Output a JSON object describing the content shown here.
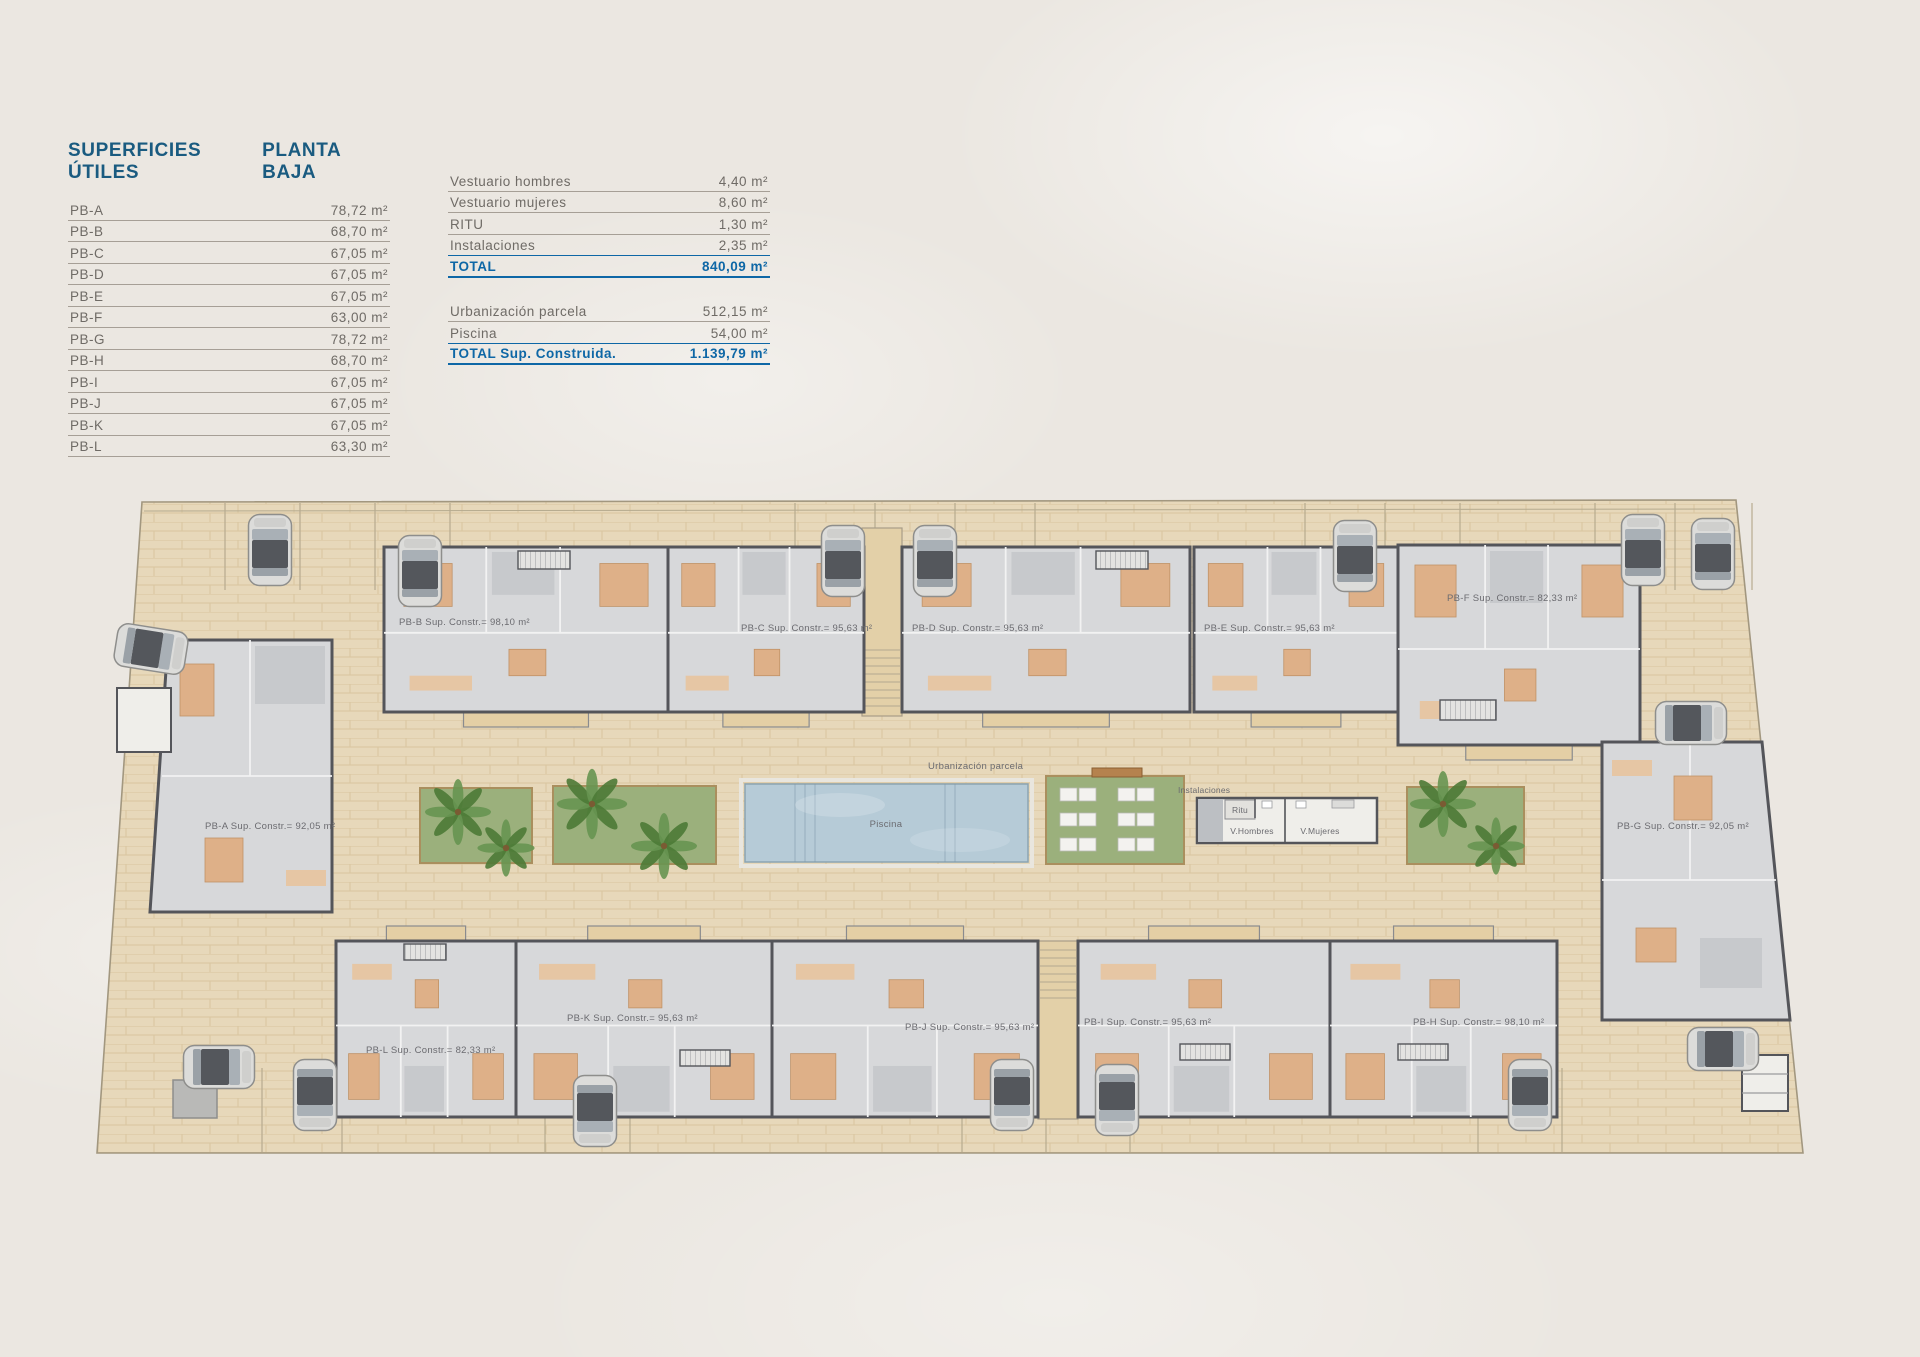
{
  "page": {
    "caption": "PLANTA BAJA"
  },
  "colors": {
    "title_blue": "#1a5b80",
    "total_blue": "#0e67a6",
    "row_text": "#6f6b66",
    "paving_tan": "#e7d8ba",
    "wall_gray": "#54555a",
    "floor_gray": "#d7d8da",
    "pool_blue": "#b6cbd7",
    "grass_green": "#9bb07c",
    "furniture_orange": "#deb088"
  },
  "tables": {
    "useful": {
      "title": "SUPERFICIES ÚTILES",
      "subtitle": "PLANTA BAJA",
      "rows": [
        {
          "label": "PB-A",
          "value": "78,72 m²"
        },
        {
          "label": "PB-B",
          "value": "68,70 m²"
        },
        {
          "label": "PB-C",
          "value": "67,05 m²"
        },
        {
          "label": "PB-D",
          "value": "67,05 m²"
        },
        {
          "label": "PB-E",
          "value": "67,05 m²"
        },
        {
          "label": "PB-F",
          "value": "63,00 m²"
        },
        {
          "label": "PB-G",
          "value": "78,72 m²"
        },
        {
          "label": "PB-H",
          "value": "68,70 m²"
        },
        {
          "label": "PB-I",
          "value": "67,05 m²"
        },
        {
          "label": "PB-J",
          "value": "67,05 m²"
        },
        {
          "label": "PB-K",
          "value": "67,05 m²"
        },
        {
          "label": "PB-L",
          "value": "63,30 m²"
        }
      ]
    },
    "summary": {
      "rows": [
        {
          "label": "Vestuario hombres",
          "value": "4,40 m²"
        },
        {
          "label": "Vestuario mujeres",
          "value": "8,60 m²"
        },
        {
          "label": "RITU",
          "value": "1,30 m²"
        },
        {
          "label": "Instalaciones",
          "value": "2,35 m²"
        }
      ],
      "total": {
        "label": "TOTAL",
        "value": "840,09 m²"
      },
      "extra_rows": [
        {
          "label": "Urbanización parcela",
          "value": "512,15 m²"
        },
        {
          "label": "Piscina",
          "value": "54,00 m²"
        }
      ],
      "grand_total": {
        "label": "TOTAL Sup. Construida.",
        "value": "1.139,79 m²"
      }
    }
  },
  "plan": {
    "units": [
      {
        "id": "PB-A",
        "label": "PB-A Sup. Constr.= 92,05 m²"
      },
      {
        "id": "PB-B",
        "label": "PB-B Sup. Constr.= 98,10 m²"
      },
      {
        "id": "PB-C",
        "label": "PB-C Sup. Constr.= 95,63 m²"
      },
      {
        "id": "PB-D",
        "label": "PB-D Sup. Constr.= 95,63 m²"
      },
      {
        "id": "PB-E",
        "label": "PB-E Sup. Constr.= 95,63 m²"
      },
      {
        "id": "PB-F",
        "label": "PB-F Sup. Constr.= 82,33 m²"
      },
      {
        "id": "PB-G",
        "label": "PB-G Sup. Constr.= 92,05 m²"
      },
      {
        "id": "PB-H",
        "label": "PB-H Sup. Constr.= 98,10 m²"
      },
      {
        "id": "PB-I",
        "label": "PB-I Sup. Constr.= 95,63 m²"
      },
      {
        "id": "PB-J",
        "label": "PB-J Sup. Constr.= 95,63 m²"
      },
      {
        "id": "PB-K",
        "label": "PB-K Sup. Constr.= 95,63 m²"
      },
      {
        "id": "PB-L",
        "label": "PB-L Sup. Constr.= 82,33 m²"
      }
    ],
    "labels": {
      "urbanizacion": "Urbanización parcela",
      "piscina": "Piscina",
      "instalaciones": "Instalaciones",
      "ritu": "Ritu",
      "v_hombres": "V.Hombres",
      "v_mujeres": "V.Mujeres"
    }
  }
}
